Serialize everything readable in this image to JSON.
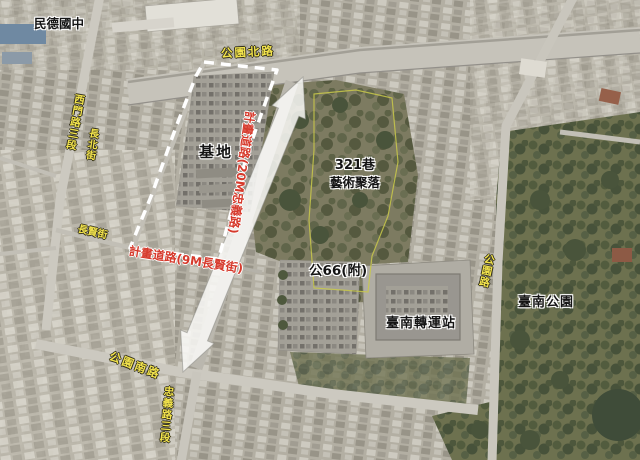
{
  "map": {
    "type": "annotated-aerial-map",
    "labels": {
      "school": "民德國中",
      "park_north_road": "公園北路",
      "ximen_road": "西門路三段",
      "changbei_street": "長北街",
      "changxian_street": "長賢街",
      "park_south_road": "公園南路",
      "zhongyi_road": "忠義路三段",
      "park_road": "公園路",
      "site": "基地",
      "lane321_line1": "321巷",
      "lane321_line2": "藝術聚落",
      "gong66": "公66(附)",
      "transfer_station": "臺南轉運站",
      "tainan_park": "臺南公園",
      "planned_road_20m": "計畫道路(20M忠義路)",
      "planned_road_9m": "計畫道路(9M長賢街)"
    },
    "colors": {
      "street_label": "#f2e34c",
      "planned_road_label": "#d63a2c",
      "place_label": "#141414",
      "site_boundary_dash": "#ffffff",
      "arrow_fill": "#faf9f6",
      "lane321_boundary": "#c9c94a"
    }
  }
}
